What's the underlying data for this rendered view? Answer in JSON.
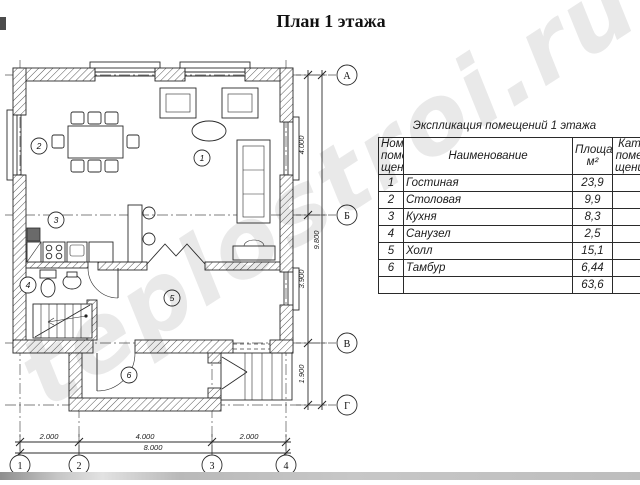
{
  "page": {
    "title": "План 1 этажа",
    "watermark": "teplostroi.ru"
  },
  "table": {
    "title": "Экспликация помещений 1 этажа",
    "col_num": "Номер\nпоме-\nщения",
    "col_name": "Наименование",
    "col_area": "Площадь\nм²",
    "col_cat": "Кат.\nпоме-\nщения",
    "rows": [
      {
        "num": "1",
        "name": "Гостиная",
        "area": "23,9"
      },
      {
        "num": "2",
        "name": "Столовая",
        "area": "9,9"
      },
      {
        "num": "3",
        "name": "Кухня",
        "area": "8,3"
      },
      {
        "num": "4",
        "name": "Санузел",
        "area": "2,5"
      },
      {
        "num": "5",
        "name": "Холл",
        "area": "15,1"
      },
      {
        "num": "6",
        "name": "Тамбур",
        "area": "6,44"
      }
    ],
    "total": "63,6"
  },
  "plan": {
    "axis_rows": [
      "А",
      "Б",
      "В",
      "Г"
    ],
    "axis_cols": [
      "1",
      "2",
      "3",
      "4"
    ],
    "rooms": [
      "1",
      "2",
      "3",
      "4",
      "5",
      "6"
    ],
    "dims_bottom": [
      "2.000",
      "4.000",
      "2.000",
      "8.000"
    ],
    "dims_right": [
      "4.000",
      "3.900",
      "1.900",
      "9.800"
    ]
  }
}
